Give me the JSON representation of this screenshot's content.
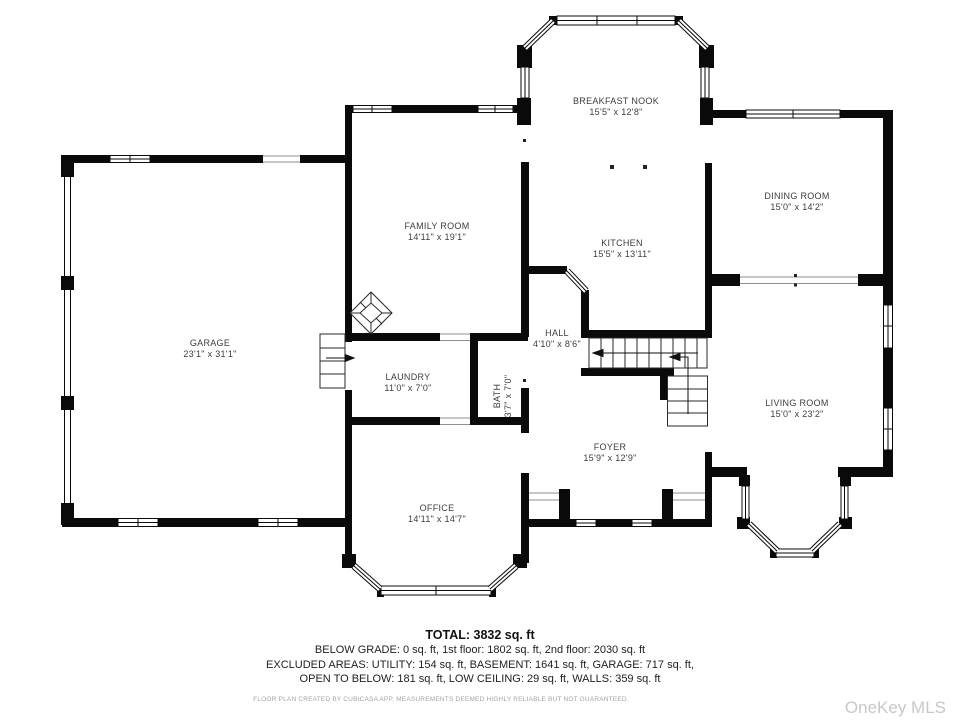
{
  "plan": {
    "rooms": [
      {
        "name": "BREAKFAST NOOK",
        "dims": "15'5\" x 12'8\""
      },
      {
        "name": "DINING ROOM",
        "dims": "15'0\" x 14'2\""
      },
      {
        "name": "FAMILY ROOM",
        "dims": "14'11\" x 19'1\""
      },
      {
        "name": "KITCHEN",
        "dims": "15'5\" x 13'11\""
      },
      {
        "name": "GARAGE",
        "dims": "23'1\" x 31'1\""
      },
      {
        "name": "HALL",
        "dims": "4'10\" x 8'6\""
      },
      {
        "name": "LAUNDRY",
        "dims": "11'0\" x 7'0\""
      },
      {
        "name": "BATH",
        "dims": "3'7\" x 7'0\""
      },
      {
        "name": "LIVING ROOM",
        "dims": "15'0\" x 23'2\""
      },
      {
        "name": "FOYER",
        "dims": "15'9\" x 12'9\""
      },
      {
        "name": "OFFICE",
        "dims": "14'11\" x 14'7\""
      }
    ],
    "icons": {
      "fireplace": "diamond-hatch",
      "stair_direction": "left-arrow"
    }
  },
  "summary": {
    "total": "TOTAL: 3832 sq. ft",
    "line1": "BELOW GRADE: 0 sq. ft, 1st floor: 1802 sq. ft, 2nd floor: 2030 sq. ft",
    "line2": "EXCLUDED AREAS: UTILITY: 154 sq. ft, BASEMENT: 1641 sq. ft, GARAGE: 717 sq. ft,",
    "line3": "OPEN TO BELOW: 181 sq. ft, LOW CEILING: 29 sq. ft, WALLS: 359 sq. ft"
  },
  "disclaimer": "FLOOR PLAN CREATED BY CUBICASA APP. MEASUREMENTS DEEMED HIGHLY RELIABLE BUT NOT GUARANTEED.",
  "watermark": "OneKey MLS"
}
